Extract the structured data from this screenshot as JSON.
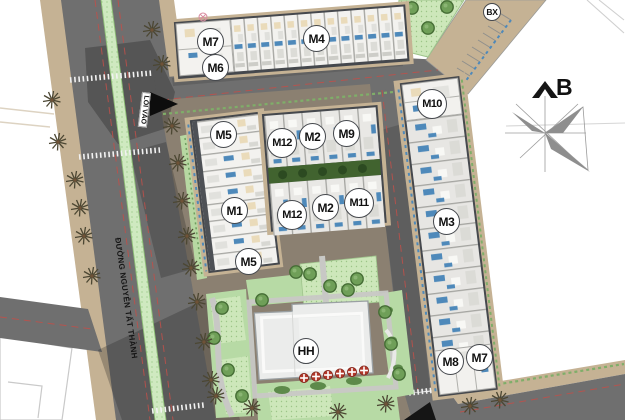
{
  "map": {
    "north_label": "B",
    "street_name": "ĐƯỜNG NGUYỄN TẤT THÀNH",
    "entrance_label": "LỐI VÀO",
    "building_labels": [
      {
        "id": "m7-north",
        "text": "M7"
      },
      {
        "id": "m6",
        "text": "M6"
      },
      {
        "id": "m4",
        "text": "M4"
      },
      {
        "id": "bx",
        "text": "BX"
      },
      {
        "id": "m10",
        "text": "M10"
      },
      {
        "id": "m5-upper",
        "text": "M5"
      },
      {
        "id": "m12-upper",
        "text": "M12"
      },
      {
        "id": "m2-upper",
        "text": "M2"
      },
      {
        "id": "m9",
        "text": "M9"
      },
      {
        "id": "m1",
        "text": "M1"
      },
      {
        "id": "m12-lower",
        "text": "M12"
      },
      {
        "id": "m2-lower",
        "text": "M2"
      },
      {
        "id": "m11",
        "text": "M11"
      },
      {
        "id": "m3",
        "text": "M3"
      },
      {
        "id": "m5-lower",
        "text": "M5"
      },
      {
        "id": "m8",
        "text": "M8"
      },
      {
        "id": "m7-south",
        "text": "M7"
      },
      {
        "id": "hh",
        "text": "HH"
      }
    ],
    "icons": {
      "north_arrow": "chevron-up",
      "compass_rose": "pinwheel-star",
      "entrance_arrow": "black-triangle",
      "palm_tree": "radial-fronds",
      "round_tree": "circle-canopy",
      "umbrella": "red-circle-white-cross",
      "utility_marker": "circle-x"
    }
  },
  "colors": {
    "road": "#6f6f6f",
    "sidewalk": "#c5b294",
    "median": "#cfe9c0",
    "ground": "#8b8071",
    "building": "#f2f1ee",
    "building_gray": "#e8e7e4",
    "block_edge": "#45484d",
    "window_blue": "#4e89ba",
    "garden_green": "#b7daa5",
    "garden_dotted": "#cde7ba",
    "courtyard_green": "#41632f",
    "umbrella_red": "#b23729",
    "road_line_red": "#c0504a",
    "crosswalk_white": "#f2f2f2"
  }
}
